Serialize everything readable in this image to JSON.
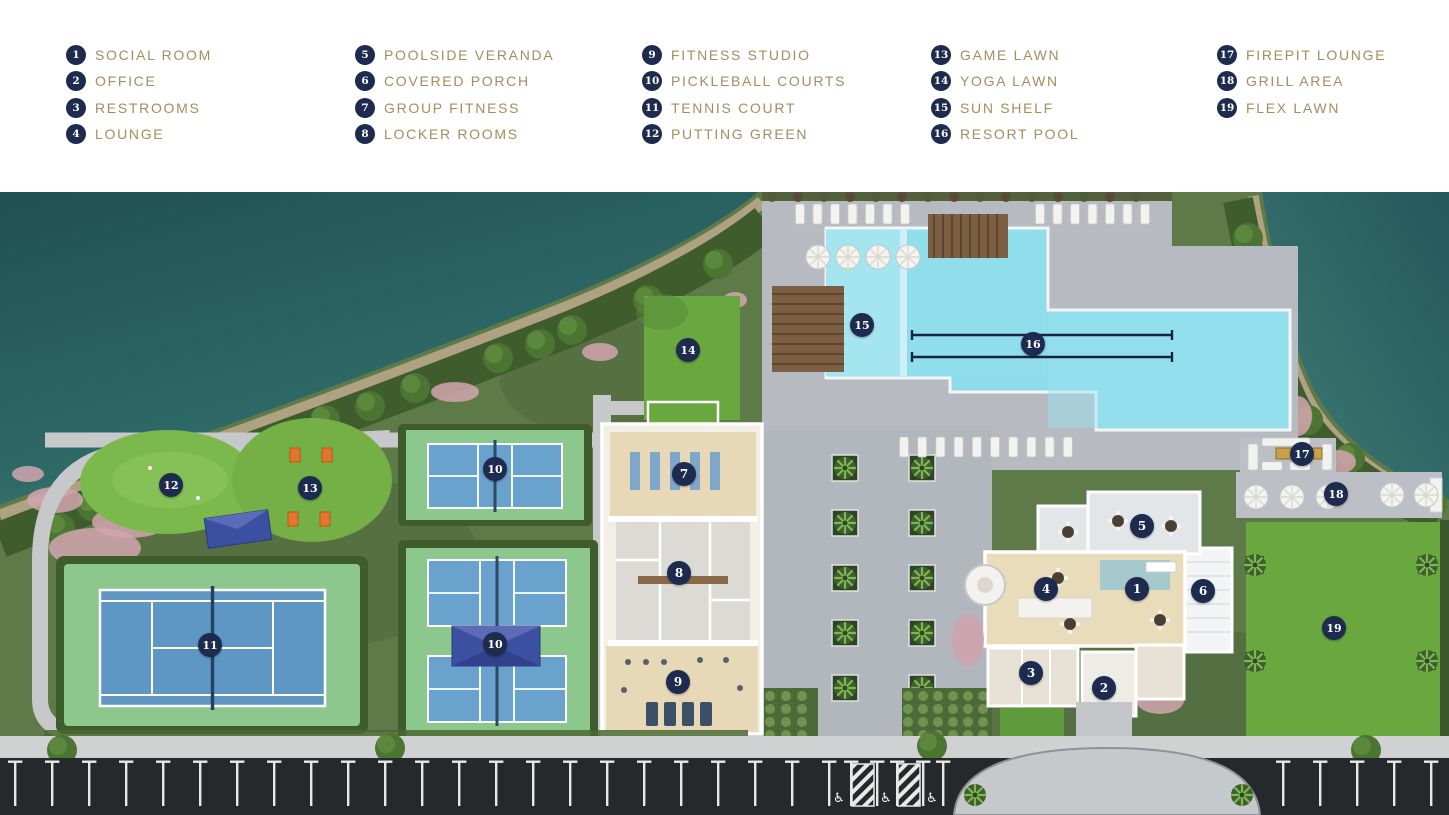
{
  "colors": {
    "navy": "#1c2b4e",
    "gold": "#a28e5e",
    "water": "#2b6164",
    "pool": "#8ddcec",
    "lawn": "#68a83f",
    "court_blue": "#5e97c4",
    "court_apron": "#8cc78e",
    "paver": "#b5b9c0",
    "asphalt": "#26292b",
    "canopy_blue": "#3c50a2",
    "pergola_wood": "#7c5f42",
    "cornhole_orange": "#e2762a"
  },
  "legend": {
    "columns": [
      [
        {
          "num": "1",
          "label": "SOCIAL ROOM"
        },
        {
          "num": "2",
          "label": "OFFICE"
        },
        {
          "num": "3",
          "label": "RESTROOMS"
        },
        {
          "num": "4",
          "label": "LOUNGE"
        }
      ],
      [
        {
          "num": "5",
          "label": "POOLSIDE VERANDA"
        },
        {
          "num": "6",
          "label": "COVERED PORCH"
        },
        {
          "num": "7",
          "label": "GROUP FITNESS"
        },
        {
          "num": "8",
          "label": "LOCKER ROOMS"
        }
      ],
      [
        {
          "num": "9",
          "label": "FITNESS STUDIO"
        },
        {
          "num": "10",
          "label": "PICKLEBALL COURTS"
        },
        {
          "num": "11",
          "label": "TENNIS COURT"
        },
        {
          "num": "12",
          "label": "PUTTING GREEN"
        }
      ],
      [
        {
          "num": "13",
          "label": "GAME LAWN"
        },
        {
          "num": "14",
          "label": "YOGA LAWN"
        },
        {
          "num": "15",
          "label": "SUN SHELF"
        },
        {
          "num": "16",
          "label": "RESORT POOL"
        }
      ],
      [
        {
          "num": "17",
          "label": "FIREPIT LOUNGE"
        },
        {
          "num": "18",
          "label": "GRILL AREA"
        },
        {
          "num": "19",
          "label": "FLEX LAWN"
        }
      ]
    ]
  },
  "map": {
    "markers": [
      {
        "num": "1",
        "x": 1137,
        "y": 589,
        "label": "SOCIAL ROOM"
      },
      {
        "num": "2",
        "x": 1104,
        "y": 688,
        "label": "OFFICE"
      },
      {
        "num": "3",
        "x": 1031,
        "y": 673,
        "label": "RESTROOMS"
      },
      {
        "num": "4",
        "x": 1046,
        "y": 589,
        "label": "LOUNGE"
      },
      {
        "num": "5",
        "x": 1142,
        "y": 526,
        "label": "POOLSIDE VERANDA"
      },
      {
        "num": "6",
        "x": 1203,
        "y": 591,
        "label": "COVERED PORCH"
      },
      {
        "num": "7",
        "x": 684,
        "y": 474,
        "label": "GROUP FITNESS"
      },
      {
        "num": "8",
        "x": 679,
        "y": 573,
        "label": "LOCKER ROOMS"
      },
      {
        "num": "9",
        "x": 678,
        "y": 682,
        "label": "FITNESS STUDIO"
      },
      {
        "num": "10",
        "x": 495,
        "y": 469,
        "label": "PICKLEBALL COURTS"
      },
      {
        "num": "10",
        "x": 495,
        "y": 644,
        "label": "PICKLEBALL COURTS"
      },
      {
        "num": "11",
        "x": 210,
        "y": 645,
        "label": "TENNIS COURT"
      },
      {
        "num": "12",
        "x": 171,
        "y": 485,
        "label": "PUTTING GREEN"
      },
      {
        "num": "13",
        "x": 310,
        "y": 488,
        "label": "GAME LAWN"
      },
      {
        "num": "14",
        "x": 688,
        "y": 350,
        "label": "YOGA LAWN"
      },
      {
        "num": "15",
        "x": 862,
        "y": 325,
        "label": "SUN SHELF"
      },
      {
        "num": "16",
        "x": 1033,
        "y": 344,
        "label": "RESORT POOL"
      },
      {
        "num": "17",
        "x": 1302,
        "y": 454,
        "label": "FIREPIT LOUNGE"
      },
      {
        "num": "18",
        "x": 1336,
        "y": 494,
        "label": "GRILL AREA"
      },
      {
        "num": "19",
        "x": 1334,
        "y": 628,
        "label": "FLEX LAWN"
      }
    ]
  }
}
